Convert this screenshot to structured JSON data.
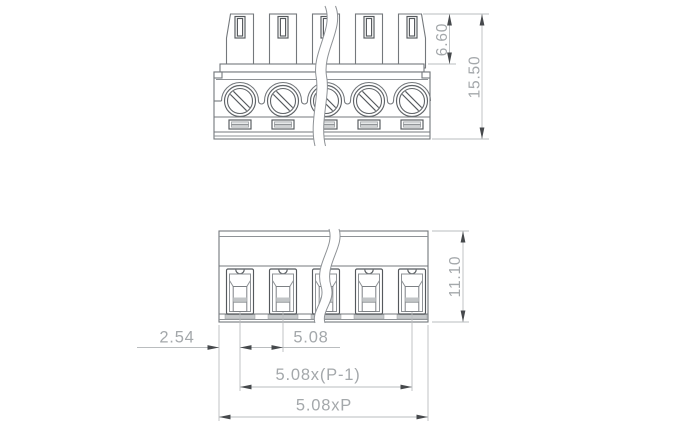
{
  "drawing": {
    "type": "technical-dimension-drawing",
    "component": "pluggable-screw-terminal-block",
    "positions_shown": 5,
    "views": [
      {
        "id": "top-view"
      },
      {
        "id": "front-view"
      }
    ],
    "dimensions": {
      "plug_height": "6.60",
      "overall_height": "15.50",
      "front_height": "11.10",
      "edge_to_first_pole": "2.54",
      "pitch": "5.08",
      "pole_span": "5.08x(P-1)",
      "overall_width": "5.08xP"
    },
    "colors": {
      "background": "#ffffff",
      "outline": "#74787c",
      "outline_dark": "#55595d",
      "outline_light": "#8e9296",
      "dimension_line": "#babdbf",
      "dimension_text": "#a4a8ab",
      "arrow": "#46494c",
      "fill_grey": "#c6c9cb"
    }
  }
}
